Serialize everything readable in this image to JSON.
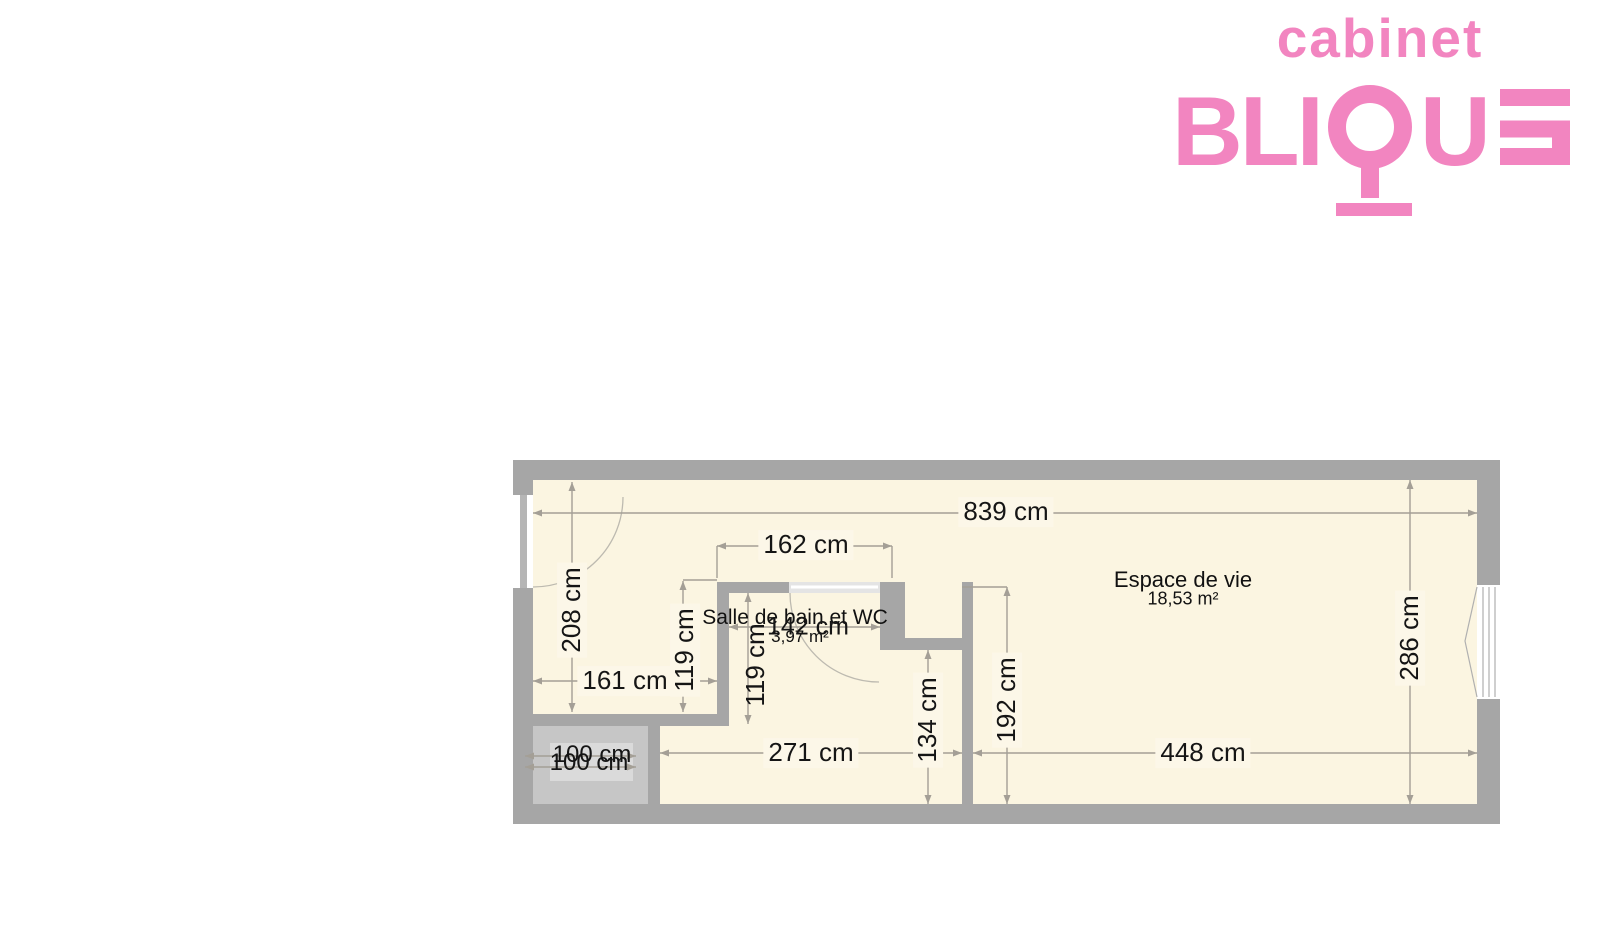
{
  "brand": {
    "line1": "cabinet",
    "part_bli": "BLI",
    "part_u": "U",
    "accent_color": "#f285c0"
  },
  "plan": {
    "rooms": [
      {
        "name": "Espace de vie",
        "area": "18,53 m²"
      },
      {
        "name": "Salle de bain et WC",
        "area": "3,97 m²"
      }
    ],
    "dimensions": {
      "top_width": "839 cm",
      "bath_outer_width": "162 cm",
      "entry_height": "208 cm",
      "entry_width": "161 cm",
      "bath_left_height": "119 cm",
      "bath_inner_height": "119 cm",
      "bath_inner_width": "142 cm",
      "hall_width": "271 cm",
      "hall_height": "134 cm",
      "living_left_height": "192 cm",
      "living_bottom_width": "448 cm",
      "living_right_height": "286 cm",
      "shaft_dim_a": "100 cm",
      "shaft_dim_b": "100 cm"
    },
    "colors": {
      "wall": "#a6a6a6",
      "floor": "#fbf5e1",
      "shaft_fill": "#c6c6c6",
      "dimension_line": "#a49f96"
    }
  }
}
